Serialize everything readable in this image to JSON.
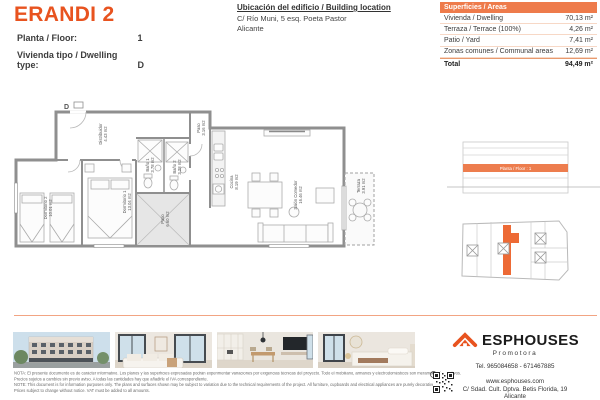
{
  "header": {
    "title": "ERANDI 2",
    "floor": {
      "label": "Planta / Floor:",
      "value": "1"
    },
    "dwelling_type": {
      "label": "Vivienda tipo / Dwelling type:",
      "value": "D"
    },
    "location": {
      "title": "Ubicación del edificio / Building location",
      "address_line1": "C/ Río Muni, 5 esq. Poeta Pastor",
      "address_line2": "Alicante"
    }
  },
  "areas_table": {
    "header": "Superficies / Areas",
    "rows": [
      {
        "label": "Vivienda / Dwelling",
        "value": "70,13 m²"
      },
      {
        "label": "Terraza / Terrace (100%)",
        "value": "4,26 m²"
      },
      {
        "label": "Patio / Yard",
        "value": "7,41 m²"
      },
      {
        "label": "Zonas comunes / Communal areas",
        "value": "12,69 m²"
      }
    ],
    "total": {
      "label": "Total",
      "value": "94,49 m²"
    }
  },
  "floor_plan": {
    "unit_letter": "D",
    "rooms": [
      {
        "name": "Distribuidor",
        "area": "4.43 m2"
      },
      {
        "name": "Dormitorio 2",
        "area": "10.01 m2"
      },
      {
        "name": "Dormitorio 1",
        "area": "13.04 m2"
      },
      {
        "name": "Baño 1",
        "area": "3.78 m2"
      },
      {
        "name": "Baño 2",
        "area": "3.28 m2"
      },
      {
        "name": "Paso",
        "area": "3.16 m2"
      },
      {
        "name": "Patio",
        "area": "6.60 m2"
      },
      {
        "name": "Cocina",
        "area": "8.19 m2"
      },
      {
        "name": "Salón Comedor",
        "area": "16.46 m2"
      },
      {
        "name": "Terraza",
        "area": "3.91 m2"
      }
    ]
  },
  "elevation": {
    "highlight_label": "Planta / Floor : 1"
  },
  "photos": [
    {
      "name": "building-exterior"
    },
    {
      "name": "living-room"
    },
    {
      "name": "kitchen-dining"
    },
    {
      "name": "bedroom"
    }
  ],
  "footer": {
    "brand": "ESPHOUSES",
    "brand_tagline": "Promotora",
    "phone": "Tel. 965084658 - 671467885",
    "website": "www.esphouses.com",
    "address_line1": "C/ Sdad. Cult. Dptva. Betis Florida, 19",
    "address_line2": "Alicante"
  },
  "disclaimer": {
    "es_line1": "NOTA: El presente documento es de carácter informativo. Los planos y las superficies expresadas podrán experimentar variaciones por exigencias técnicas del proyecto. Todo el mobiliario, armarios y electrodomésticos son meramente decorativos.",
    "es_line2": "Precios sujetos a cambios sin previo aviso. A todas las cantidades hay que añadirle el IVA correspondiente.",
    "en_line1": "NOTE: This document is for information purposes only. The plans and surfaces shown may be subject to variation due to the technical requirements of the project. All furniture, cupboards and electrical appliances are purely decorative.",
    "en_line2": "Prices subject to change without notice. VAT must be added to all amounts."
  },
  "colors": {
    "accent": "#E8531F",
    "table_header_bg": "#EE7B4B",
    "floor_highlight": "#ED7D4E",
    "unit_highlight": "#ED6A35",
    "rule": "#F2A483"
  }
}
